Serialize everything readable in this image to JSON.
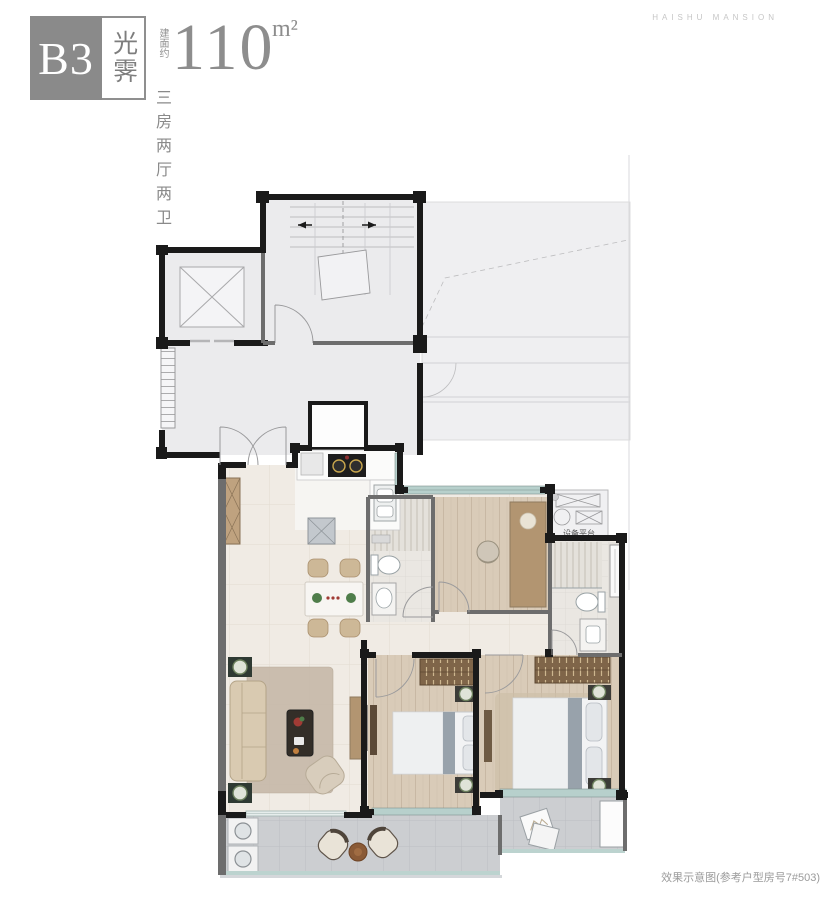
{
  "header": {
    "unit_code": "B3",
    "unit_name": "光霁",
    "area_prefix": "建面约",
    "area_value": "110",
    "area_unit": "m²",
    "layout_desc": "三房两厅两卫"
  },
  "brand": {
    "name": "HAISHU MANSION"
  },
  "plan": {
    "equipment_platform_label": "设备平台"
  },
  "footer": {
    "note": "效果示意图(参考户型房号7#503)"
  },
  "colors": {
    "wall_black": "#1a1a1a",
    "wall_gray": "#6d6d6d",
    "common_area_fill": "#ebebed",
    "floor_tile_beige": "#f0ebe4",
    "wood_floor": "#d9cbb8",
    "wardrobe_wood": "#7f6549",
    "balcony_tile": "#ccced1",
    "window_teal": "#b7d0cc",
    "badge_gray": "#8a8a8a"
  }
}
